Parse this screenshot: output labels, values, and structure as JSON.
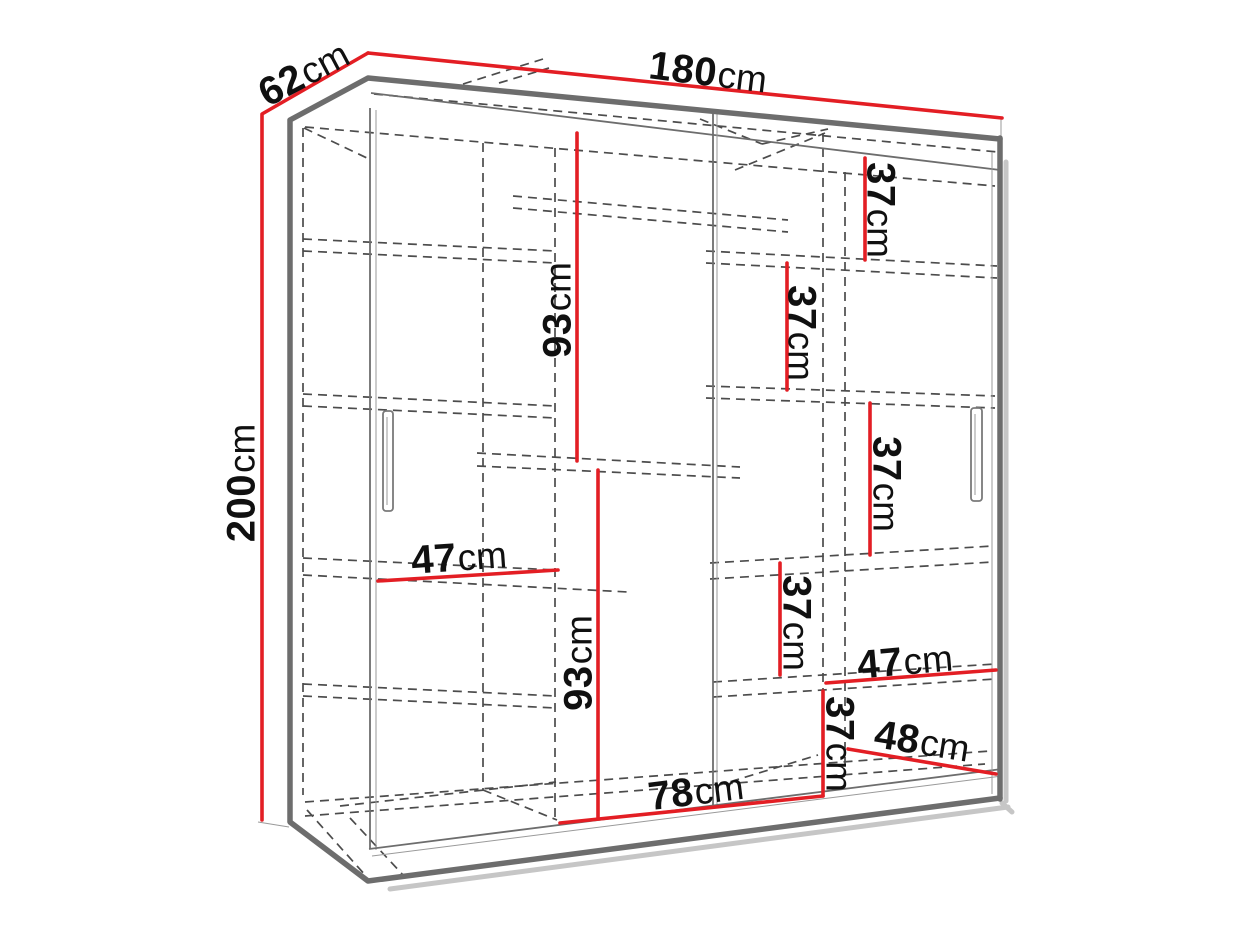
{
  "colors": {
    "dimension_red": "#e31e24",
    "frame_gray": "#6d6d6d",
    "dashed_gray": "#4c4c4c",
    "text_black": "#101010",
    "shadow_gray": "#c6c6c6",
    "background": "#ffffff"
  },
  "labels": [
    {
      "id": "depth-top",
      "value": "62",
      "unit": "cm"
    },
    {
      "id": "width-top",
      "value": "180",
      "unit": "cm"
    },
    {
      "id": "height-left",
      "value": "200",
      "unit": "cm"
    },
    {
      "id": "inner-height-upper",
      "value": "93",
      "unit": "cm"
    },
    {
      "id": "inner-height-lower",
      "value": "93",
      "unit": "cm"
    },
    {
      "id": "shelf-gap-1",
      "value": "37",
      "unit": "cm"
    },
    {
      "id": "shelf-gap-2",
      "value": "37",
      "unit": "cm"
    },
    {
      "id": "shelf-gap-3",
      "value": "37",
      "unit": "cm"
    },
    {
      "id": "shelf-gap-4",
      "value": "37",
      "unit": "cm"
    },
    {
      "id": "shelf-gap-5",
      "value": "37",
      "unit": "cm"
    },
    {
      "id": "shelf-width-left",
      "value": "47",
      "unit": "cm"
    },
    {
      "id": "shelf-width-right",
      "value": "47",
      "unit": "cm"
    },
    {
      "id": "shelf-width-bottom-right",
      "value": "48",
      "unit": "cm"
    },
    {
      "id": "inner-width-bottom",
      "value": "78",
      "unit": "cm"
    }
  ]
}
